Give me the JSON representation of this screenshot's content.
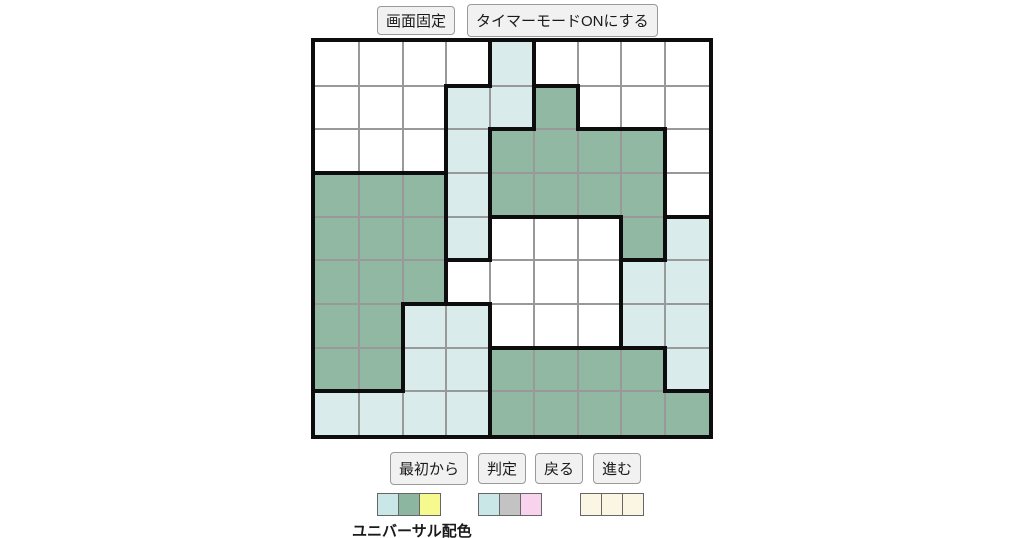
{
  "toolbar_top": {
    "fix_screen_label": "画面固定",
    "timer_mode_label": "タイマーモードONにする"
  },
  "toolbar_bottom": {
    "restart_label": "最初から",
    "check_label": "判定",
    "undo_label": "戻る",
    "redo_label": "進む"
  },
  "palette": {
    "universal_label": "ユニバーサル配色",
    "groups": [
      {
        "name": "universal",
        "colors": [
          "#c9e7e7",
          "#8db6a0",
          "#f6f98e"
        ]
      },
      {
        "name": "normal",
        "colors": [
          "#c9e7e7",
          "#c3c3c3",
          "#f9d3ee"
        ]
      },
      {
        "name": "plain",
        "colors": [
          "#fbf6e3",
          "#fbf6e3",
          "#fbf6e3"
        ]
      }
    ]
  },
  "board": {
    "rows": 9,
    "cols": 9,
    "color_palette": {
      "w": "#ffffff",
      "g": "#90b8a2",
      "b": "#d9ebeb"
    },
    "grid_line_color": "#999999",
    "bold_line_color": "#0d0d0d",
    "cell_colors": [
      "wwwwbwwww",
      "wwwbbgwww",
      "wwwbggggw",
      "gggbggggw",
      "gggbwwwgb",
      "gggwwwwbb",
      "ggbbwwwbb",
      "ggbbggggb",
      "bbbbggggg"
    ],
    "bold_right": [
      "000110000",
      "001011000",
      "001100010",
      "001100010",
      "001100110",
      "001000100",
      "010100100",
      "010100010",
      "000100000"
    ],
    "bold_bottom": [
      "000101000",
      "000010110",
      "111000000",
      "000011101",
      "000100010",
      "001100000",
      "000011110",
      "110000001",
      "000000000"
    ]
  }
}
